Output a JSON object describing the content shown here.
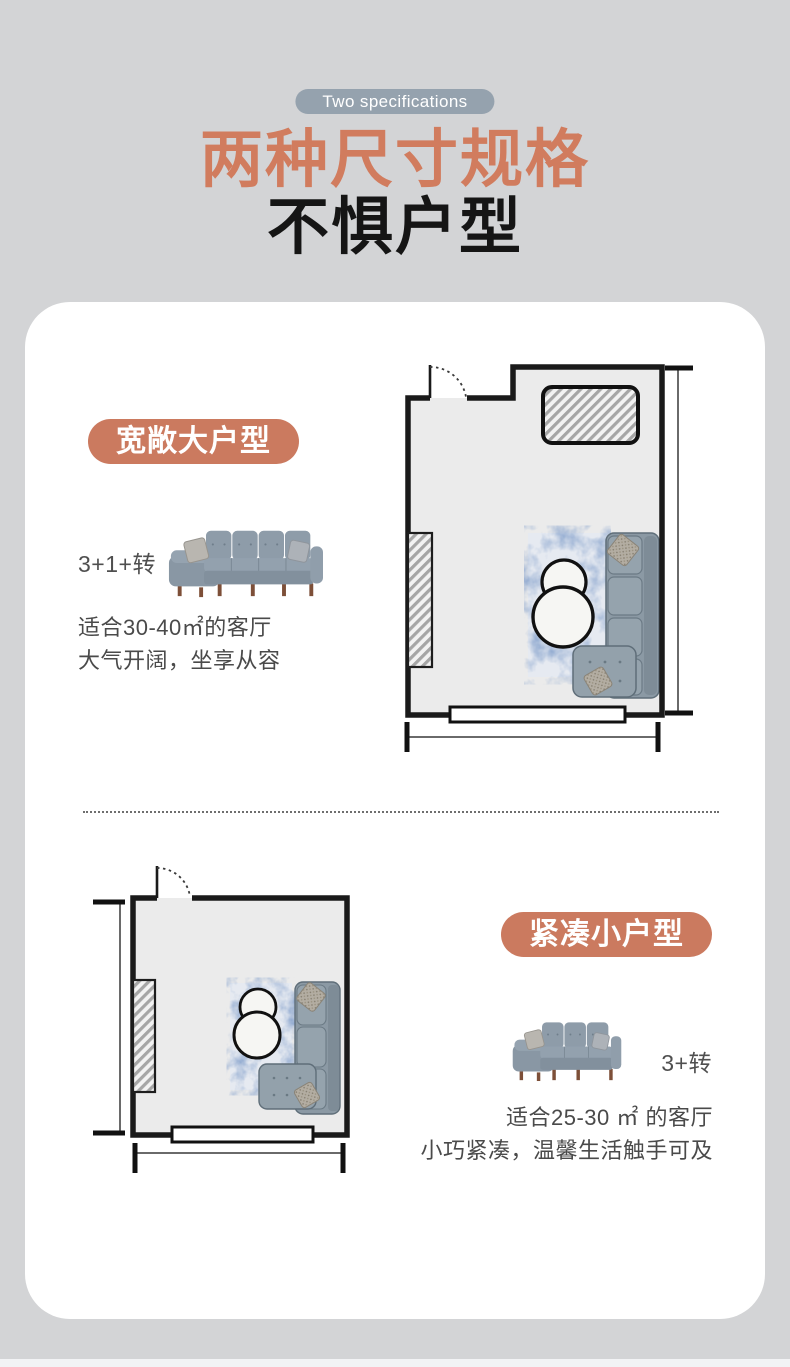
{
  "header": {
    "tag": "Two specifications",
    "title": "两种尺寸规格",
    "subtitle": "不惧户型"
  },
  "colors": {
    "page_bg": "#d3d4d6",
    "card_bg": "#ffffff",
    "accent_terracotta": "#cb7a5f",
    "title_terracotta": "#d17c5e",
    "tag_gray_blue": "#95a2ae",
    "body_text": "#4a4a4a",
    "floorplan_wall": "#1a1a1a",
    "floorplan_room_fill": "#ebebeb",
    "sofa_fabric": "#8e9ca9"
  },
  "sections": [
    {
      "badge": "宽敞大户型",
      "config_label": "3+1+转",
      "desc_line1": "适合30-40㎡的客厅",
      "desc_line2": "大气开阔，坐享从容",
      "sofa_illustration": "l-shaped-sectional-sofa-3-plus-1-plus-chaise",
      "floorplan_illustration": "large-living-room-floorplan"
    },
    {
      "badge": "紧凑小户型",
      "config_label": "3+转",
      "desc_line1": "适合25-30 ㎡ 的客厅",
      "desc_line2": "小巧紧凑，温馨生活触手可及",
      "sofa_illustration": "l-shaped-sectional-sofa-3-plus-chaise",
      "floorplan_illustration": "small-living-room-floorplan"
    }
  ]
}
